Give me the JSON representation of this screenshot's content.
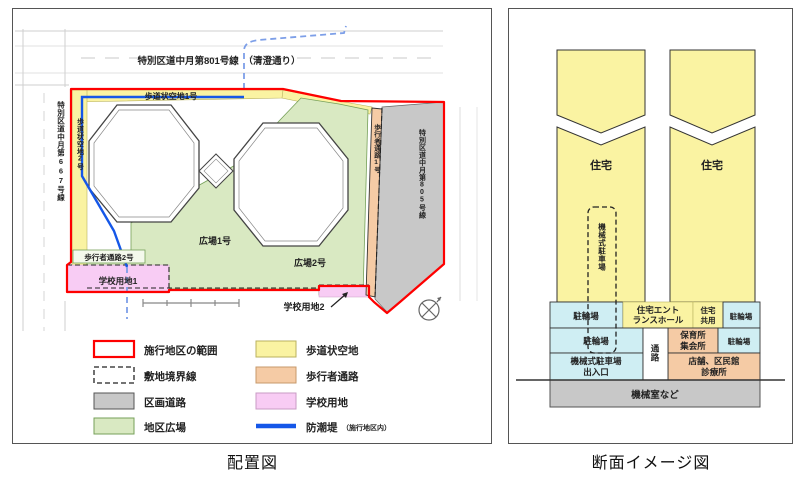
{
  "captions": {
    "site_plan": "配置図",
    "section": "断面イメージ図"
  },
  "colors": {
    "yellow": "#faf3a2",
    "cyan": "#cfeef3",
    "orange": "#f5cba5",
    "pink": "#f8ccf4",
    "green": "#d9e9c2",
    "gray": "#c8c8c8",
    "red": "#fe0000",
    "blue": "#1557e8",
    "blue_dashed": "#7d9fe8"
  },
  "site_plan": {
    "road_top": "特別区道中月第801号線　（清澄通り）",
    "road_left": "特別区道中月第667号線",
    "road_right": "特別区道中月第805号線",
    "sidewalk_1": "歩道状空地1号",
    "sidewalk_2": "歩道状空地2号",
    "path_1": "歩行者通路1号",
    "path_2": "歩行者通路2号",
    "plaza_1": "広場1号",
    "plaza_2": "広場2号",
    "school_1": "学校用地1",
    "school_2": "学校用地2",
    "legend": [
      {
        "label": "施行地区の範囲",
        "swatch": "red-outline"
      },
      {
        "label": "敷地境界線",
        "swatch": "dashed-outline"
      },
      {
        "label": "区画道路",
        "swatch": "gray"
      },
      {
        "label": "地区広場",
        "swatch": "green"
      },
      {
        "label": "歩道状空地",
        "swatch": "yellow"
      },
      {
        "label": "歩行者通路",
        "swatch": "orange"
      },
      {
        "label": "学校用地",
        "swatch": "pink"
      },
      {
        "label": "防潮堤",
        "note": "（施行地区内）",
        "swatch": "blue-line"
      }
    ]
  },
  "section": {
    "tower_left": "住宅",
    "tower_right": "住宅",
    "shaft": "機械式駐車場",
    "corridor": "通路",
    "row1": {
      "b1": "駐輪場",
      "b2": [
        "住宅エント",
        "ランスホール"
      ],
      "b3": [
        "住宅",
        "共用"
      ],
      "b4": "駐輪場"
    },
    "row2": {
      "b1": "駐輪場",
      "b2": [
        "保育所",
        "集会所"
      ],
      "b3": "駐輪場"
    },
    "row3": {
      "b1": [
        "機械式駐車場",
        "出入口"
      ],
      "b2": [
        "店舗、区民館",
        "診療所"
      ]
    },
    "base": "機械室など"
  }
}
